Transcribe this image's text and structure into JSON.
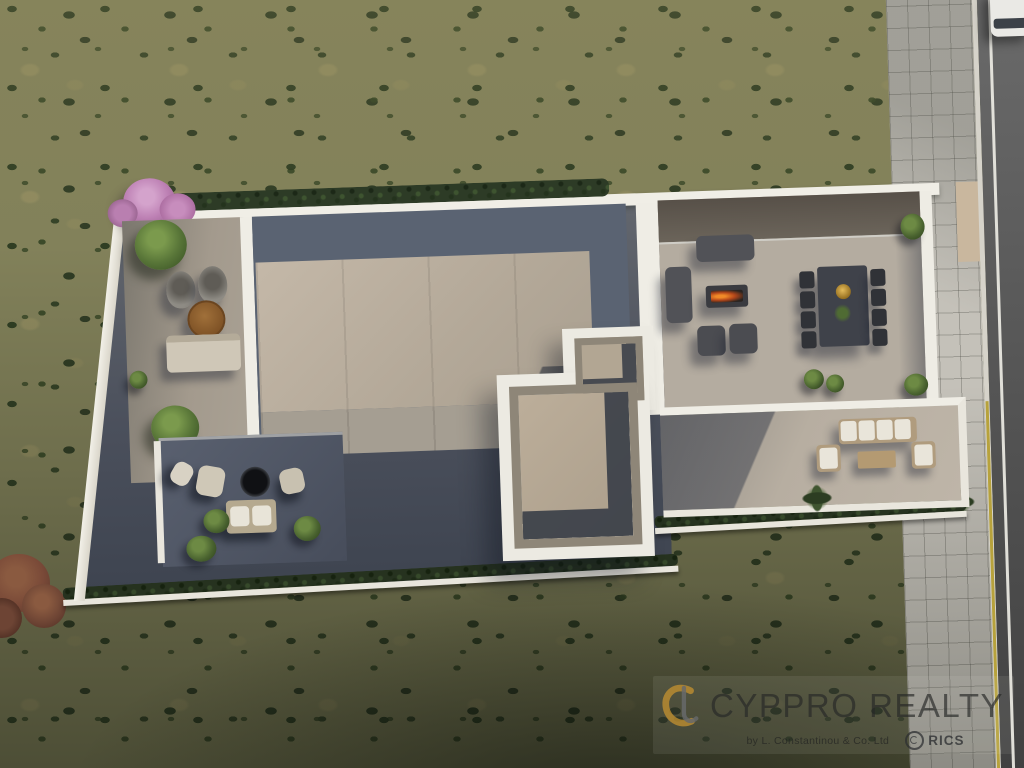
{
  "image": {
    "type": "aerial-3d-render",
    "description": "Top-down aerial 3D architectural render of a modern flat-roof villa with furnished roof terraces on a landscaped plot in dry scrubland; tiled sidewalk and asphalt road with a parked white car along the right edge; real-estate watermark at bottom right",
    "width_px": 1024,
    "height_px": 768
  },
  "palette": {
    "scrub_light": "#82815a",
    "scrub_patch": "#9c9468",
    "bush_green": "#2b3a20",
    "scrub_dark_bottom": "#3e4233",
    "wall_white": "#f0eee6",
    "roof_beige": "#b9ab9b",
    "roof_shadow_slate": "#5a6372",
    "terrace_light": "#b4aca0",
    "terrace_dark_stone": "#4f5665",
    "stair_roof_taupe": "#b2a693",
    "hedge_green": "#2d3b26",
    "blossom_pink": "#bc7fb3",
    "tree_green": "#587538",
    "palm_green": "#3f5530",
    "autumn_russet": "#7a4a38",
    "road_asphalt": "#535353",
    "road_line_white": "#edebE4",
    "curb_yellow": "#b7a23c",
    "sidewalk_tile": "#c4c1b9",
    "car_white": "#eae9e5",
    "furniture_dark_grey": "#515257",
    "furniture_beige": "#cfc7b7",
    "cushion_white": "#e9e5da",
    "fire_orange": "#f08a28",
    "dining_table_black": "#3f424a",
    "brass_bowl_gold": "#e4bb5a",
    "wood_table": "#8a5c30"
  },
  "scene": {
    "surroundings": {
      "terrain": "dry scrubland with scattered dark green bushes and tan clearings",
      "road": "asphalt road along right edge with white edge line and yellow curb line",
      "sidewalk": "grid-tiled pavement between plot and road",
      "car": "white car parked on road at top right corner",
      "autumn_tree": "russet-leaved tree at lower left edge"
    },
    "villa": {
      "boundary": [
        "white perimeter parapet walls, plot slightly rotated",
        "dark green clipped hedge along top wall",
        "hedge row and low wall along bottom boundary",
        "pink blossom tree at top-left corner"
      ],
      "areas": [
        {
          "name": "left-courtyard",
          "floor": "part-shaded concrete",
          "furniture": [
            "two woven hanging chairs",
            "round wooden coffee table",
            "beige outdoor sofa",
            "two green trees"
          ]
        },
        {
          "name": "main-roof",
          "floor": "large beige concrete slab with slate-blue shaded band along top and right edges"
        },
        {
          "name": "right-terrace",
          "floor": "light concrete with dark planted band and glass rail at top",
          "furniture": [
            "dark grey three-seat sofa",
            "dark grey side sofa",
            "fire-pit coffee table with lit fire",
            "two dark grey armchairs",
            "black dining table with brass bowl and plant",
            "eight black dining chairs"
          ]
        },
        {
          "name": "stair-core",
          "description": "raised white-walled stepped roof-access structure with two recessed taupe roof wells in deep shadow"
        },
        {
          "name": "lower-left-terrace",
          "floor": "dark stone in shade",
          "furniture": [
            "two cushioned loungers",
            "round black fire bowl",
            "daybed with two white pillows",
            "clipped green shrubs"
          ]
        },
        {
          "name": "lower-right-terrace",
          "floor": "light concrete crossed by long diagonal shadow",
          "furniture": [
            "sofa with white cushions",
            "two white-cushion armchairs",
            "wooden coffee table",
            "palm shrubs"
          ]
        }
      ]
    }
  },
  "watermark": {
    "brand": "CYPPRO REALTY",
    "byline": "by L. Constantinou & Co. Ltd",
    "rics_label": "RICS",
    "brand_color": "rgba(42,44,42,0.8)",
    "monogram_gold": "#c59433",
    "monogram_grey": "#6e7176"
  }
}
